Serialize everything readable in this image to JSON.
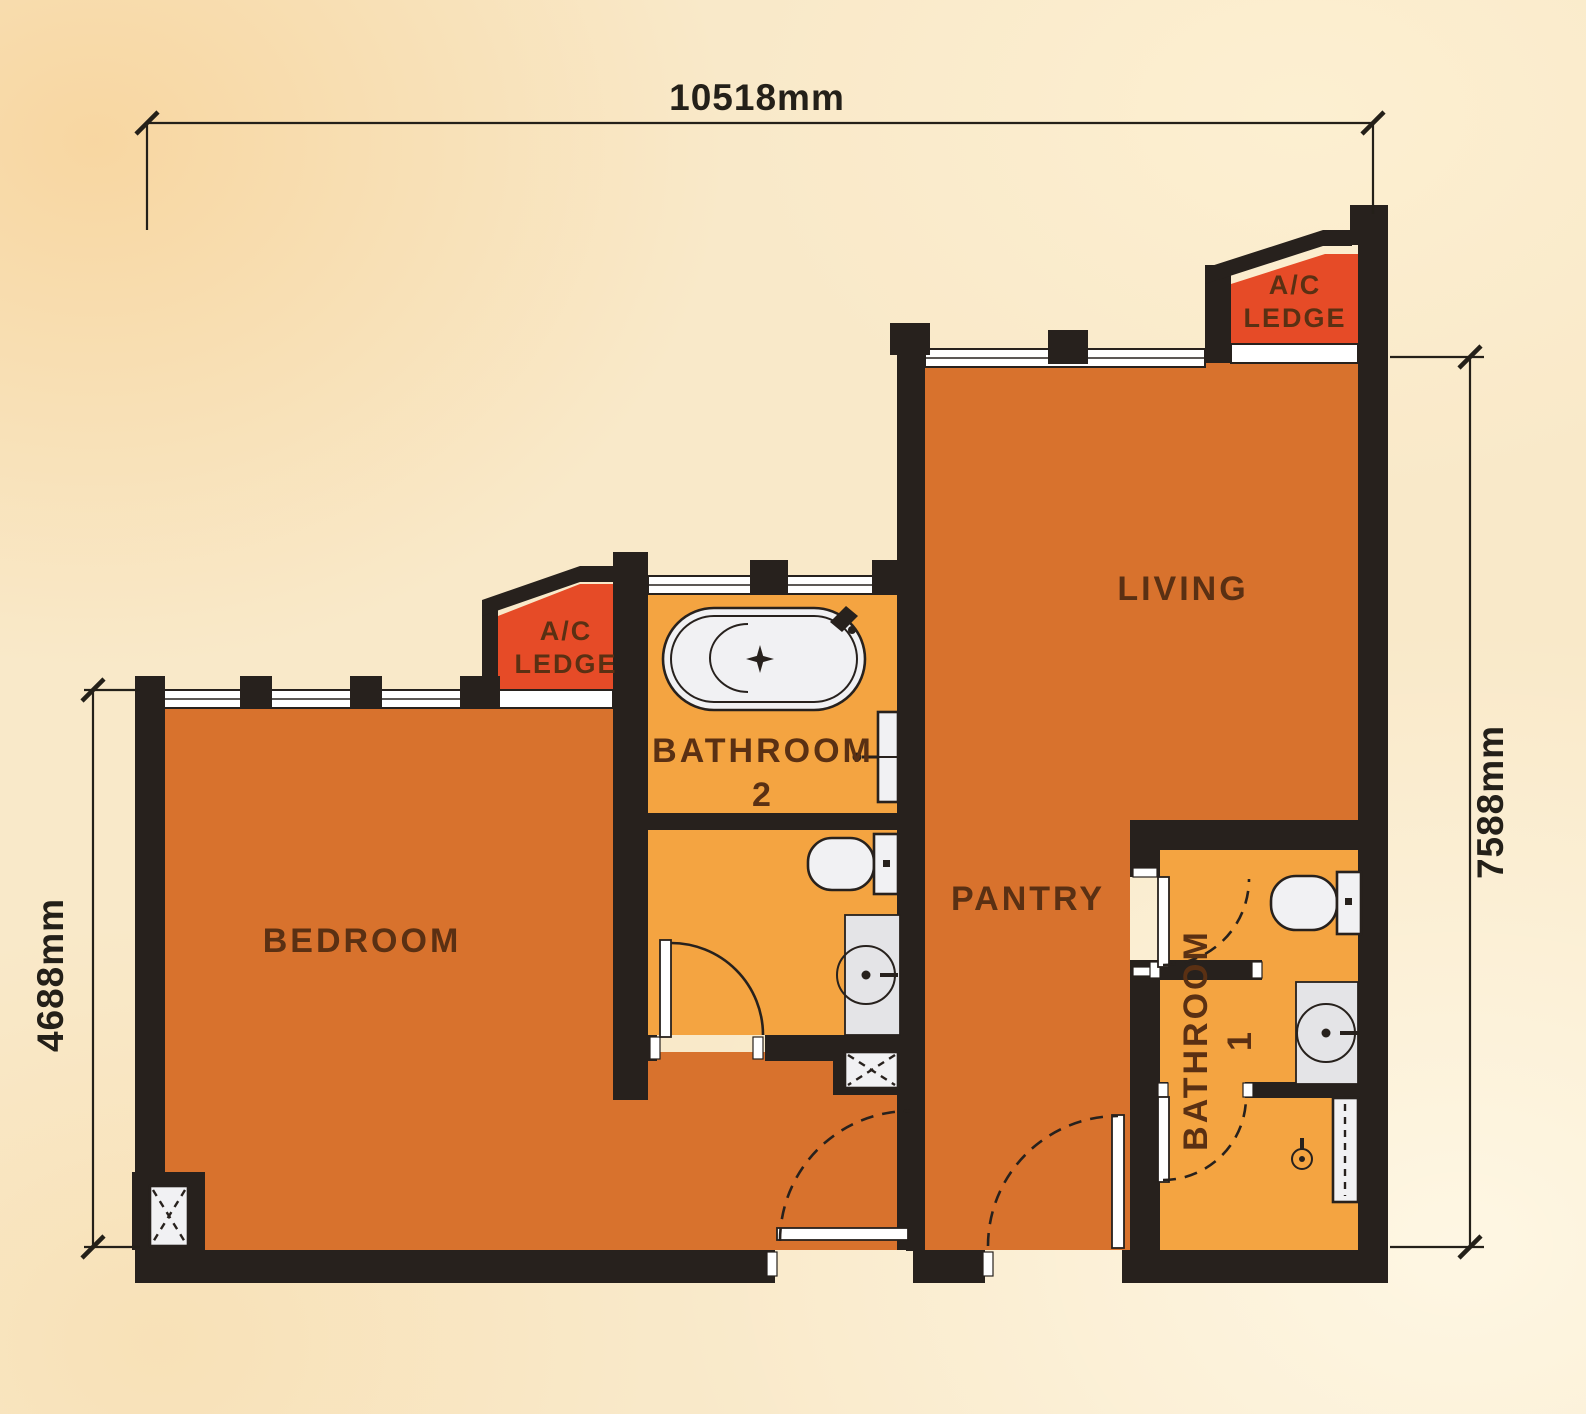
{
  "title": "Apartment Unit Floor Plan",
  "dimensions": {
    "top": "10518mm",
    "right": "7588mm",
    "left": "4688mm"
  },
  "rooms": {
    "bedroom": "BEDROOM",
    "living": "LIVING",
    "pantry": "PANTRY",
    "bathroom2": {
      "line1": "BATHROOM",
      "line2": "2"
    },
    "bathroom1": {
      "line1": "BATHROOM",
      "line2": "1"
    },
    "ac_ledge": {
      "line1": "A/C",
      "line2": "LEDGE"
    }
  },
  "colors": {
    "background": "#f9e9c9",
    "wall": "#27211d",
    "room": "#d8722d",
    "bathroom": "#f4a441",
    "ledge": "#e64b27",
    "label": "#5a3013",
    "dimension": "#242019",
    "fixture": "#f1f1f3",
    "counter": "#e4e4e7"
  }
}
